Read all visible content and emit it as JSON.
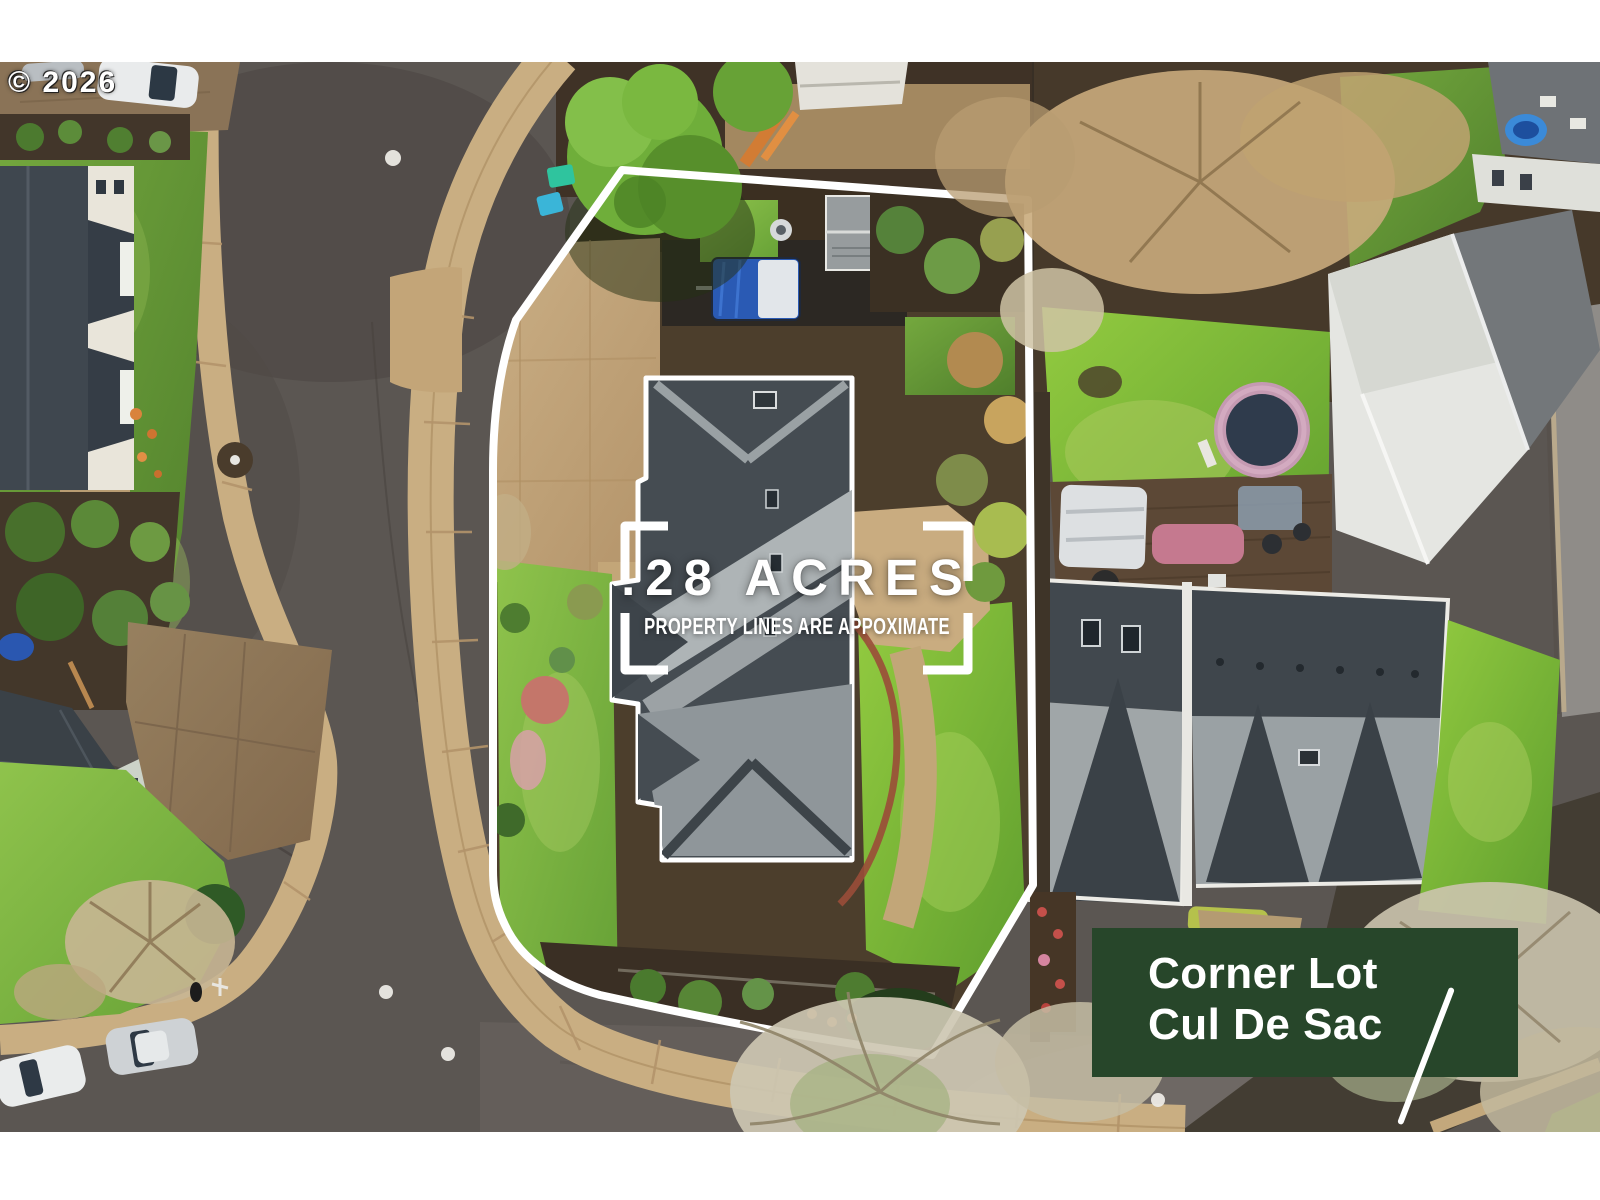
{
  "watermark": {
    "text": "© 2026"
  },
  "lot_callout": {
    "acreage": ".28 ACRES",
    "disclaimer": "PROPERTY LINES ARE APPOXIMATE"
  },
  "feature_banner": {
    "line1": "Corner Lot",
    "line2": "Cul De Sac"
  },
  "colors": {
    "banner_bg": "#27462A",
    "overlay_text": "#FFFFFF",
    "property_outline": "#FFFFFF"
  }
}
